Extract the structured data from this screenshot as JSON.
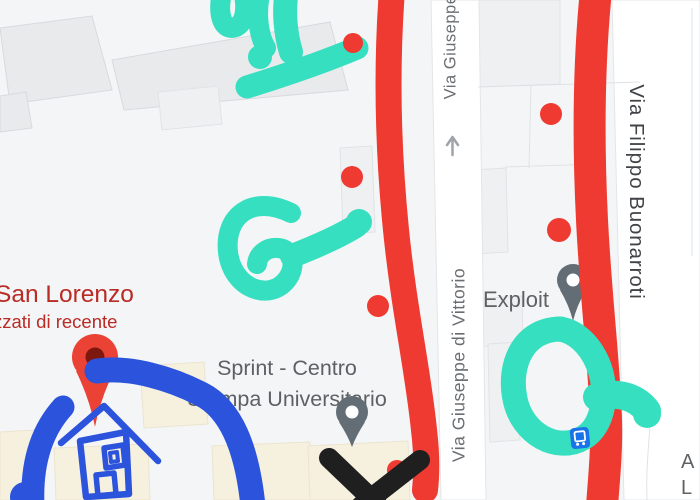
{
  "pois": {
    "san_lorenzo": {
      "name": "San Lorenzo",
      "subtitle_fragment": "zzati di recente"
    },
    "sprint": {
      "name_line1": "Sprint - Centro",
      "name_line2": "Stampa Universitario"
    },
    "exploit": {
      "name": "Exploit"
    },
    "edge_fragment": {
      "line1": "A",
      "line2": "L"
    }
  },
  "streets": {
    "top_label": "Via Giuseppe",
    "center_label": "Via Giuseppe di Vittorio",
    "right_label": "Via Filippo Buonarroti"
  },
  "icons": {
    "red_map_pin": "san-lorenzo location pin",
    "gray_map_pin_sprint": "sprint location pin",
    "gray_map_pin_exploit": "exploit location pin",
    "transit_station": "transit station icon",
    "one_way_arrow": "one-way street arrow"
  },
  "annotations": {
    "red_lines": 2,
    "red_dots": 6,
    "teal_squiggles": 3,
    "blue_drawing": "house with two curved strokes",
    "black_mark": "X cross"
  },
  "colors": {
    "annotation_red": "#ee3a30",
    "annotation_teal": "#35dfc0",
    "annotation_blue": "#2b53dc",
    "annotation_black": "#1f1f1f",
    "poi_red_text": "#b92b25",
    "poi_gray_text": "#5e6164",
    "street_gray": "#6a6e72",
    "street_dark": "#404347",
    "pin_red": "#ea4335",
    "pin_gray": "#626d75",
    "transit_blue": "#1a73e8",
    "map_bg": "#f4f5f6"
  }
}
